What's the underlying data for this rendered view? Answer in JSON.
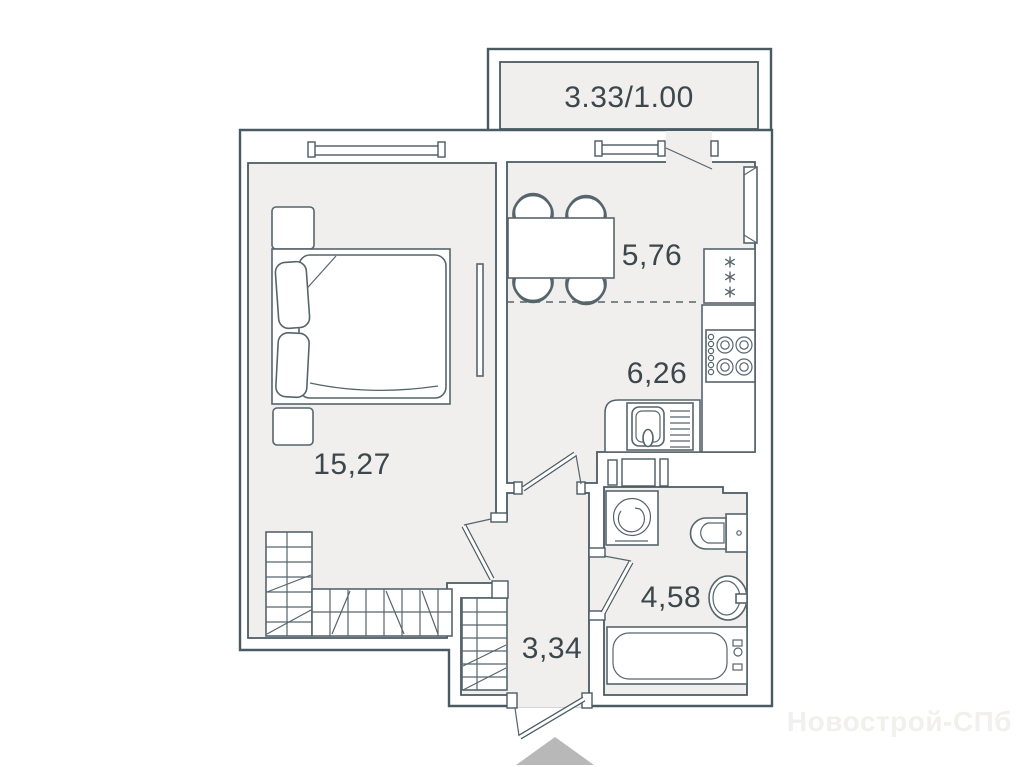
{
  "palette": {
    "wall_line": "#4a5a62",
    "fixture_line": "#56656c",
    "room_fill": "#f0efed",
    "background": "#ffffff",
    "entry_arrow": "#b8b8b8",
    "label_color": "#3c474d",
    "watermark_color": "#f1f0ed"
  },
  "balcony": {
    "area_label": "3.33/1.00"
  },
  "rooms": {
    "living_room": {
      "area_label": "15,27"
    },
    "dining_zone": {
      "area_label": "5,76"
    },
    "kitchen_zone": {
      "area_label": "6,26"
    },
    "bathroom": {
      "area_label": "4,58"
    },
    "hallway": {
      "area_label": "3,34"
    }
  },
  "watermark": {
    "text": "Новострой-СПб"
  }
}
